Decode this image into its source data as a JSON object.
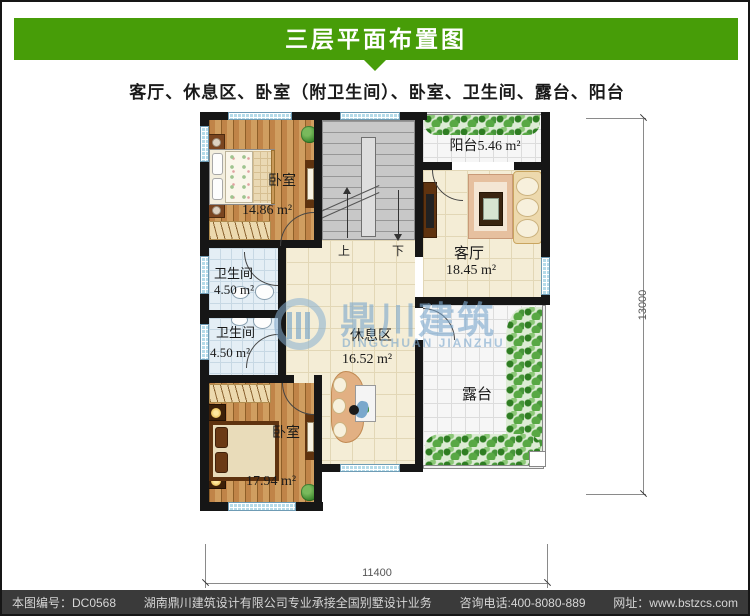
{
  "title": "三层平面布置图",
  "subtitle": "客厅、休息区、卧室（附卫生间）、卧室、卫生间、露台、阳台",
  "colors": {
    "banner_green": "#479d08",
    "footer_bg": "#3a3a3a"
  },
  "rooms": {
    "bedroom_top": {
      "name": "卧室",
      "area": "14.86 m²"
    },
    "balcony": {
      "name": "阳台",
      "area": "5.46 m²"
    },
    "living": {
      "name": "客厅",
      "area": "18.45 m²"
    },
    "bath_upper": {
      "name": "卫生间",
      "area": "4.50 m²"
    },
    "bath_lower": {
      "name": "卫生间",
      "area": "4.50 m²"
    },
    "rest": {
      "name": "休息区",
      "area": "16.52 m²"
    },
    "bedroom_bottom": {
      "name": "卧室",
      "area": "17.94 m²"
    },
    "terrace": {
      "name": "露台"
    }
  },
  "stairs": {
    "up": "上",
    "down": "下"
  },
  "dimensions": {
    "bottom": "11400",
    "right": "13000"
  },
  "watermark": {
    "cn": "鼎川建筑",
    "en": "DINGCHUAN JIANZHU"
  },
  "footer": {
    "plan_no": "本图编号：DC0568",
    "company": "湖南鼎川建筑设计有限公司专业承接全国别墅设计业务",
    "phone": "咨询电话:400-8080-889",
    "website": "网址：www.bstzcs.com"
  }
}
